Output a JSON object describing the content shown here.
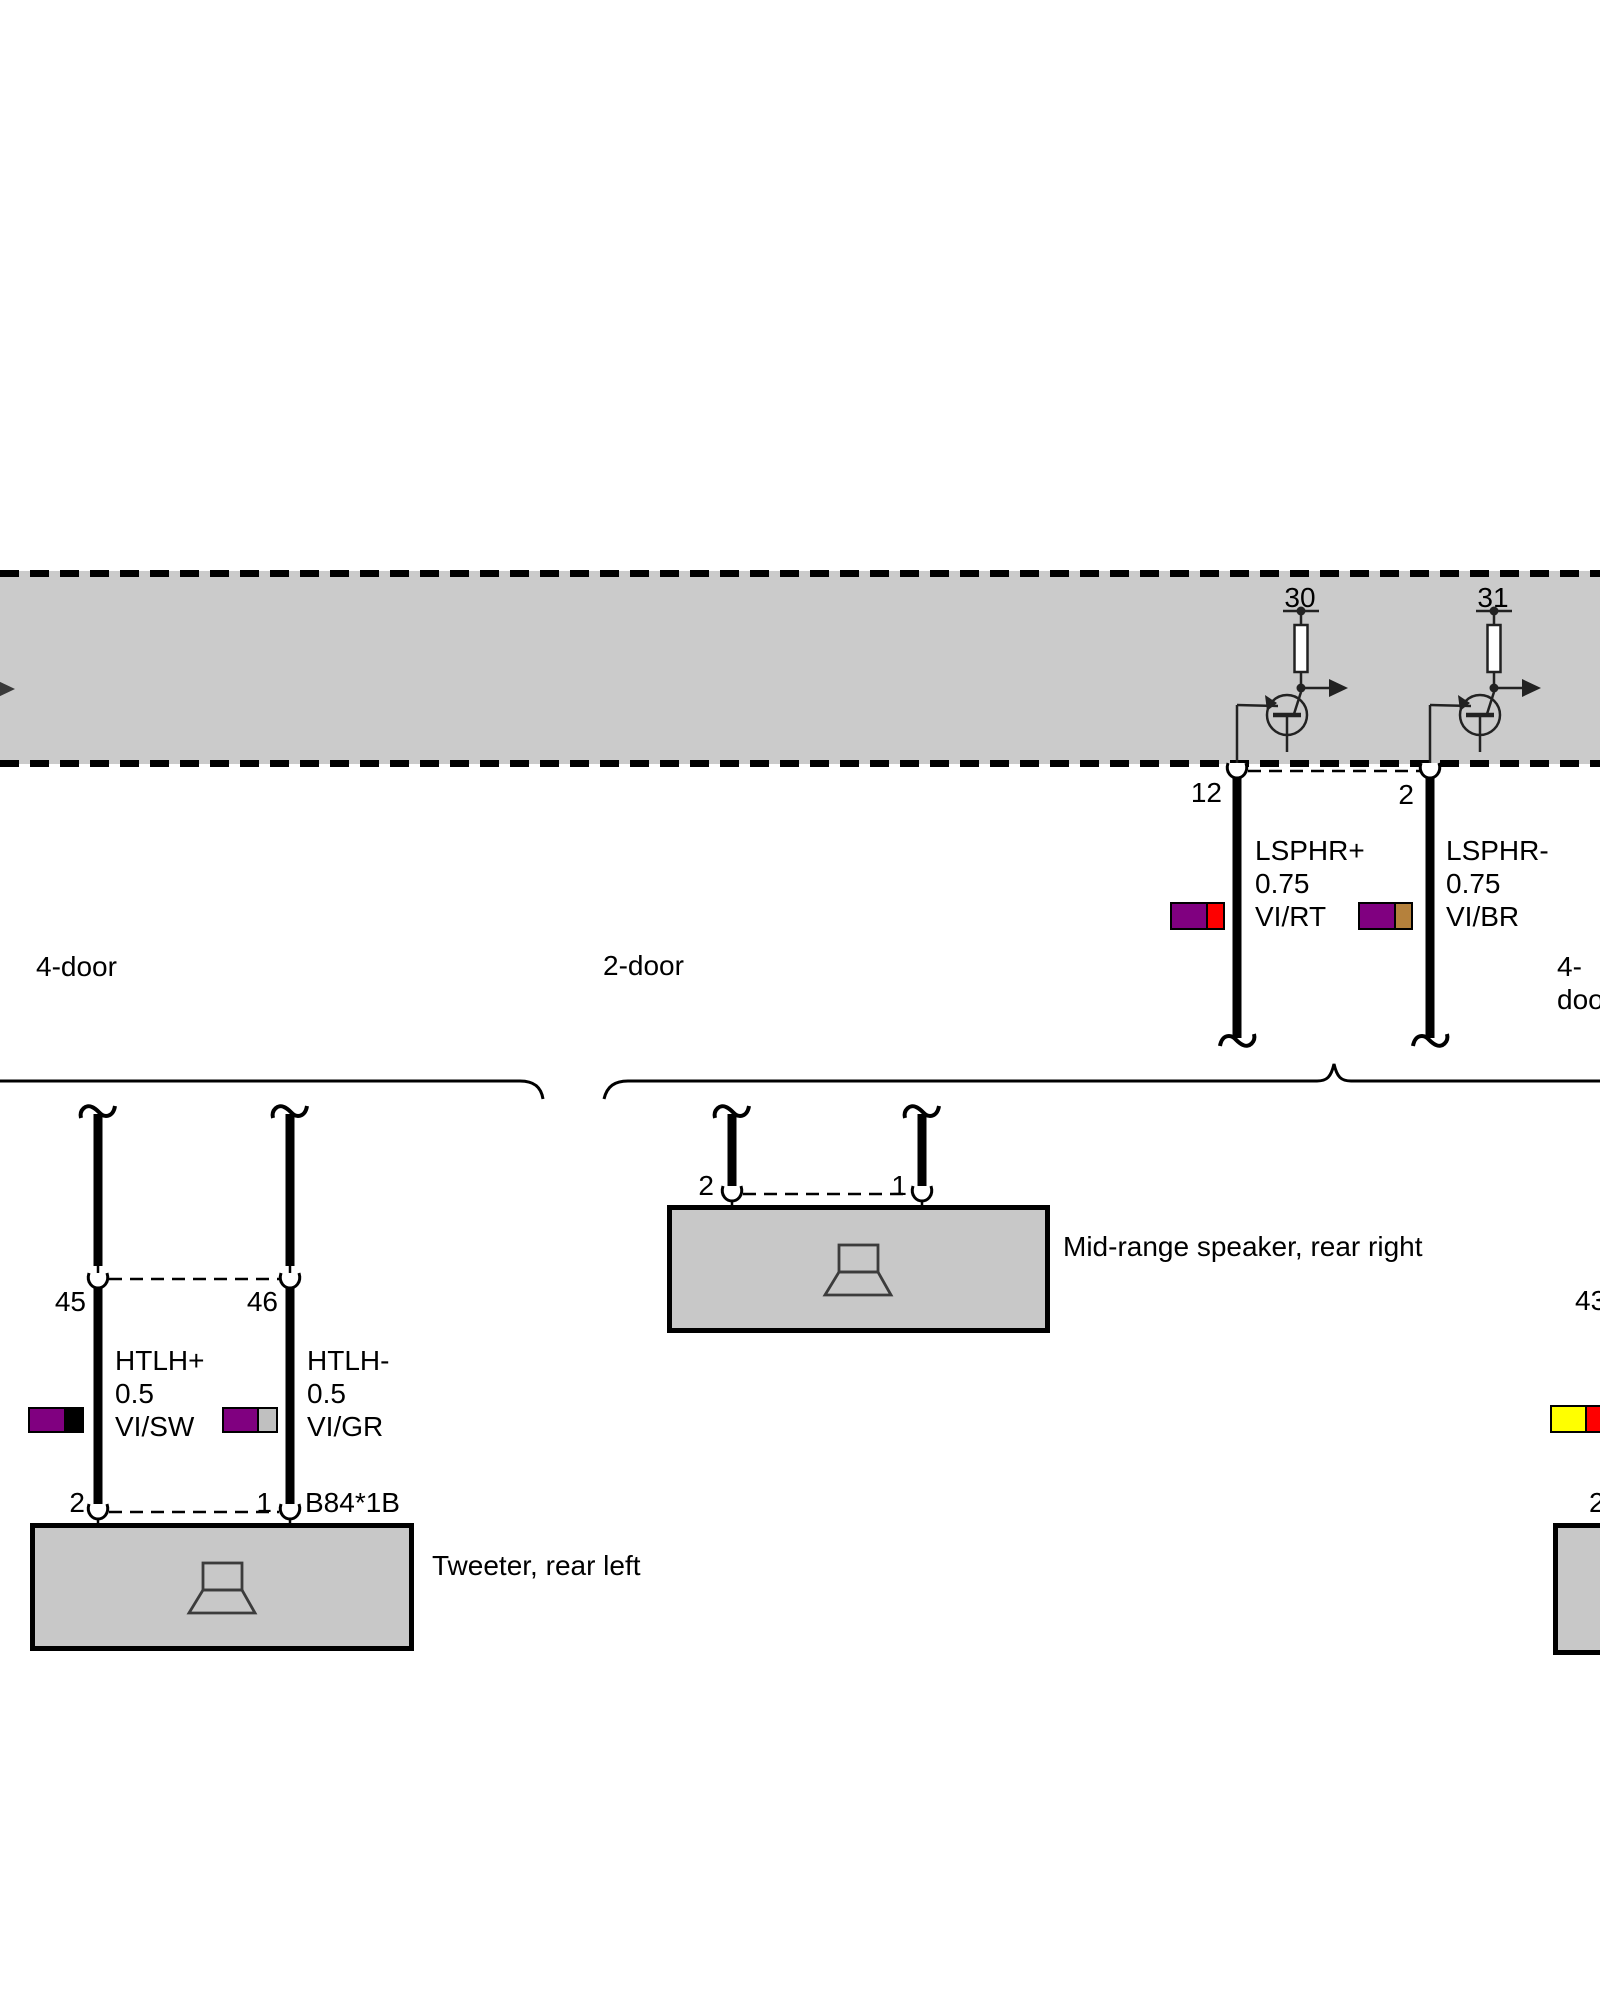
{
  "palette": {
    "band_fill": "#cbcbcb",
    "box_fill": "#c8c8c8",
    "violet": "#800080",
    "red": "#fe0000",
    "brown": "#b5813c",
    "black": "#000000",
    "grey": "#c0c0c0",
    "yellow": "#ffff00"
  },
  "band": {
    "pin30": "30",
    "pin31": "31"
  },
  "connector_band": {
    "pin_left": "12",
    "pin_right": "2"
  },
  "wires": {
    "lsphr_plus": {
      "label": "LSPHR+\n0.75\nVI/RT",
      "color_main": "#800080",
      "color_stripe": "#fe0000"
    },
    "lsphr_minus": {
      "label": "LSPHR-\n0.75\nVI/BR",
      "color_main": "#800080",
      "color_stripe": "#b5813c"
    },
    "htlh_plus": {
      "label": "HTLH+\n0.5\nVI/SW",
      "color_main": "#800080",
      "color_stripe": "#000000"
    },
    "htlh_minus": {
      "label": "HTLH-\n0.5\nVI/GR",
      "color_main": "#800080",
      "color_stripe": "#c0c0c0"
    },
    "ge_rt": {
      "color_main": "#ffff00",
      "color_stripe": "#fe0000"
    }
  },
  "variants": {
    "left": "4-door",
    "middle": "2-door",
    "right": "4-door"
  },
  "connectors": {
    "left_top": {
      "pin_left": "45",
      "pin_right": "46"
    },
    "left_bottom": {
      "pin_left": "2",
      "pin_right": "1",
      "code": "B84*1B"
    },
    "mid": {
      "pin_left": "2",
      "pin_right": "1"
    },
    "right": {
      "pin_top": "43",
      "pin_bottom": "2"
    }
  },
  "components": {
    "tweeter": "Tweeter, rear left",
    "midrange": "Mid-range speaker, rear right"
  }
}
